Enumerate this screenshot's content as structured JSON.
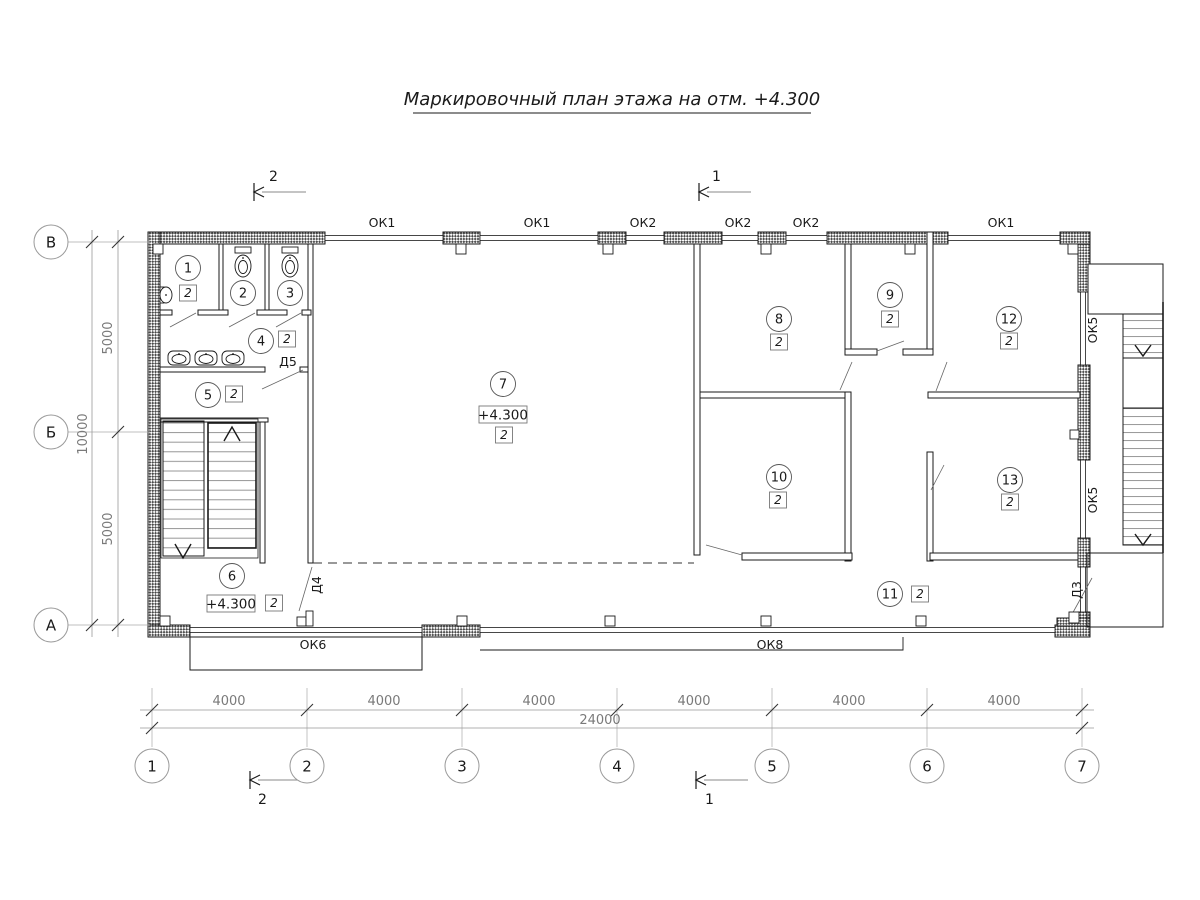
{
  "title": "Маркировочный план этажа на отм. +4.300",
  "grid": {
    "columns": [
      "1",
      "2",
      "3",
      "4",
      "5",
      "6",
      "7"
    ],
    "rows": [
      "В",
      "Б",
      "А"
    ],
    "bottom_dims": [
      "4000",
      "4000",
      "4000",
      "4000",
      "4000",
      "4000"
    ],
    "bottom_total": "24000",
    "left_dims": [
      "5000",
      "5000"
    ],
    "left_total": "10000"
  },
  "sections": {
    "left": "2",
    "right": "1"
  },
  "windows": {
    "top": [
      "ОК1",
      "ОК1",
      "ОК2",
      "ОК2",
      "ОК2",
      "ОК1"
    ],
    "bottom": [
      "ОК6",
      "ОК8"
    ],
    "right": [
      "ОК5",
      "ОК5"
    ]
  },
  "doors": [
    "Д5",
    "Д4",
    "Д3"
  ],
  "rooms": [
    {
      "number": "1",
      "badge": "2"
    },
    {
      "number": "2"
    },
    {
      "number": "3"
    },
    {
      "number": "4",
      "badge": "2"
    },
    {
      "number": "5",
      "badge": "2"
    },
    {
      "number": "6",
      "badge": "2",
      "elevation": "+4.300"
    },
    {
      "number": "7",
      "badge": "2",
      "elevation": "+4.300"
    },
    {
      "number": "8",
      "badge": "2"
    },
    {
      "number": "9",
      "badge": "2"
    },
    {
      "number": "10",
      "badge": "2"
    },
    {
      "number": "11",
      "badge": "2"
    },
    {
      "number": "12",
      "badge": "2"
    },
    {
      "number": "13",
      "badge": "2"
    }
  ],
  "colors": {
    "line": "#1a1a1a",
    "dim_text": "#7a7a7a"
  }
}
